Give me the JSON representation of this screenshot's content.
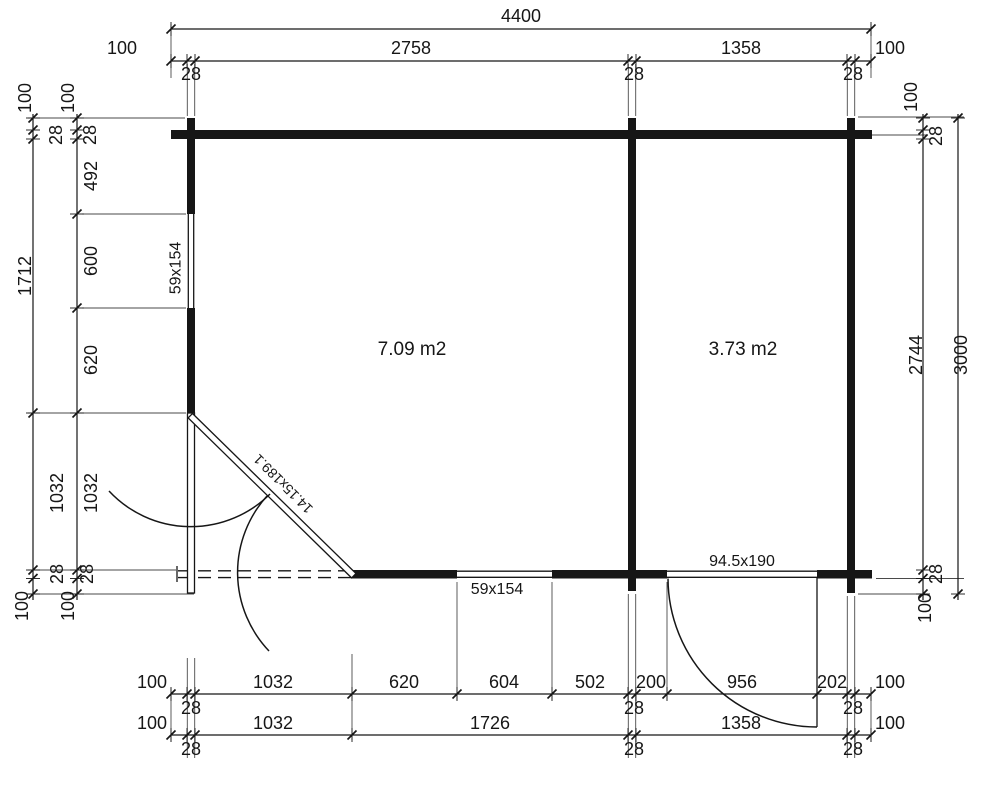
{
  "colors": {
    "line": "#161616",
    "background": "#ffffff"
  },
  "rooms": {
    "left_area": "7.09 m2",
    "right_area": "3.73 m2"
  },
  "openings": {
    "left_window": "59x154",
    "bottom_window": "59x154",
    "corner_door": "14.15x189.1",
    "right_door": "94.5x190"
  },
  "dims": {
    "top": {
      "total": "4400",
      "left_100": "100",
      "seg_2758": "2758",
      "seg_1358": "1358",
      "right_100": "100",
      "t28_left": "28",
      "t28_mid": "28",
      "t28_right": "28"
    },
    "bottom_row1": {
      "left_100": "100",
      "seg_1032": "1032",
      "seg_620": "620",
      "seg_604": "604",
      "seg_502": "502",
      "seg_200": "200",
      "seg_956": "956",
      "seg_202": "202",
      "right_100": "100",
      "t28_left": "28",
      "t28_mid": "28",
      "t28_right": "28"
    },
    "bottom_row2": {
      "left_100": "100",
      "seg_1032": "1032",
      "seg_1726": "1726",
      "seg_1358": "1358",
      "right_100": "100",
      "t28_left": "28",
      "t28_mid": "28",
      "t28_right": "28"
    },
    "left_outer": {
      "top_100": "100",
      "top_28": "28",
      "seg_1712": "1712",
      "seg_1032": "1032",
      "bottom_28": "28",
      "bottom_100": "100"
    },
    "left_inner": {
      "top_100": "100",
      "top_28": "28",
      "seg_492": "492",
      "seg_600": "600",
      "seg_620": "620",
      "seg_1032": "1032",
      "bottom_28": "28",
      "bottom_100": "100"
    },
    "right_inner": {
      "top_100": "100",
      "top_28": "28",
      "seg_2744": "2744",
      "bottom_28": "28",
      "bottom_100": "100"
    },
    "right_outer": {
      "seg_3000": "3000"
    }
  }
}
